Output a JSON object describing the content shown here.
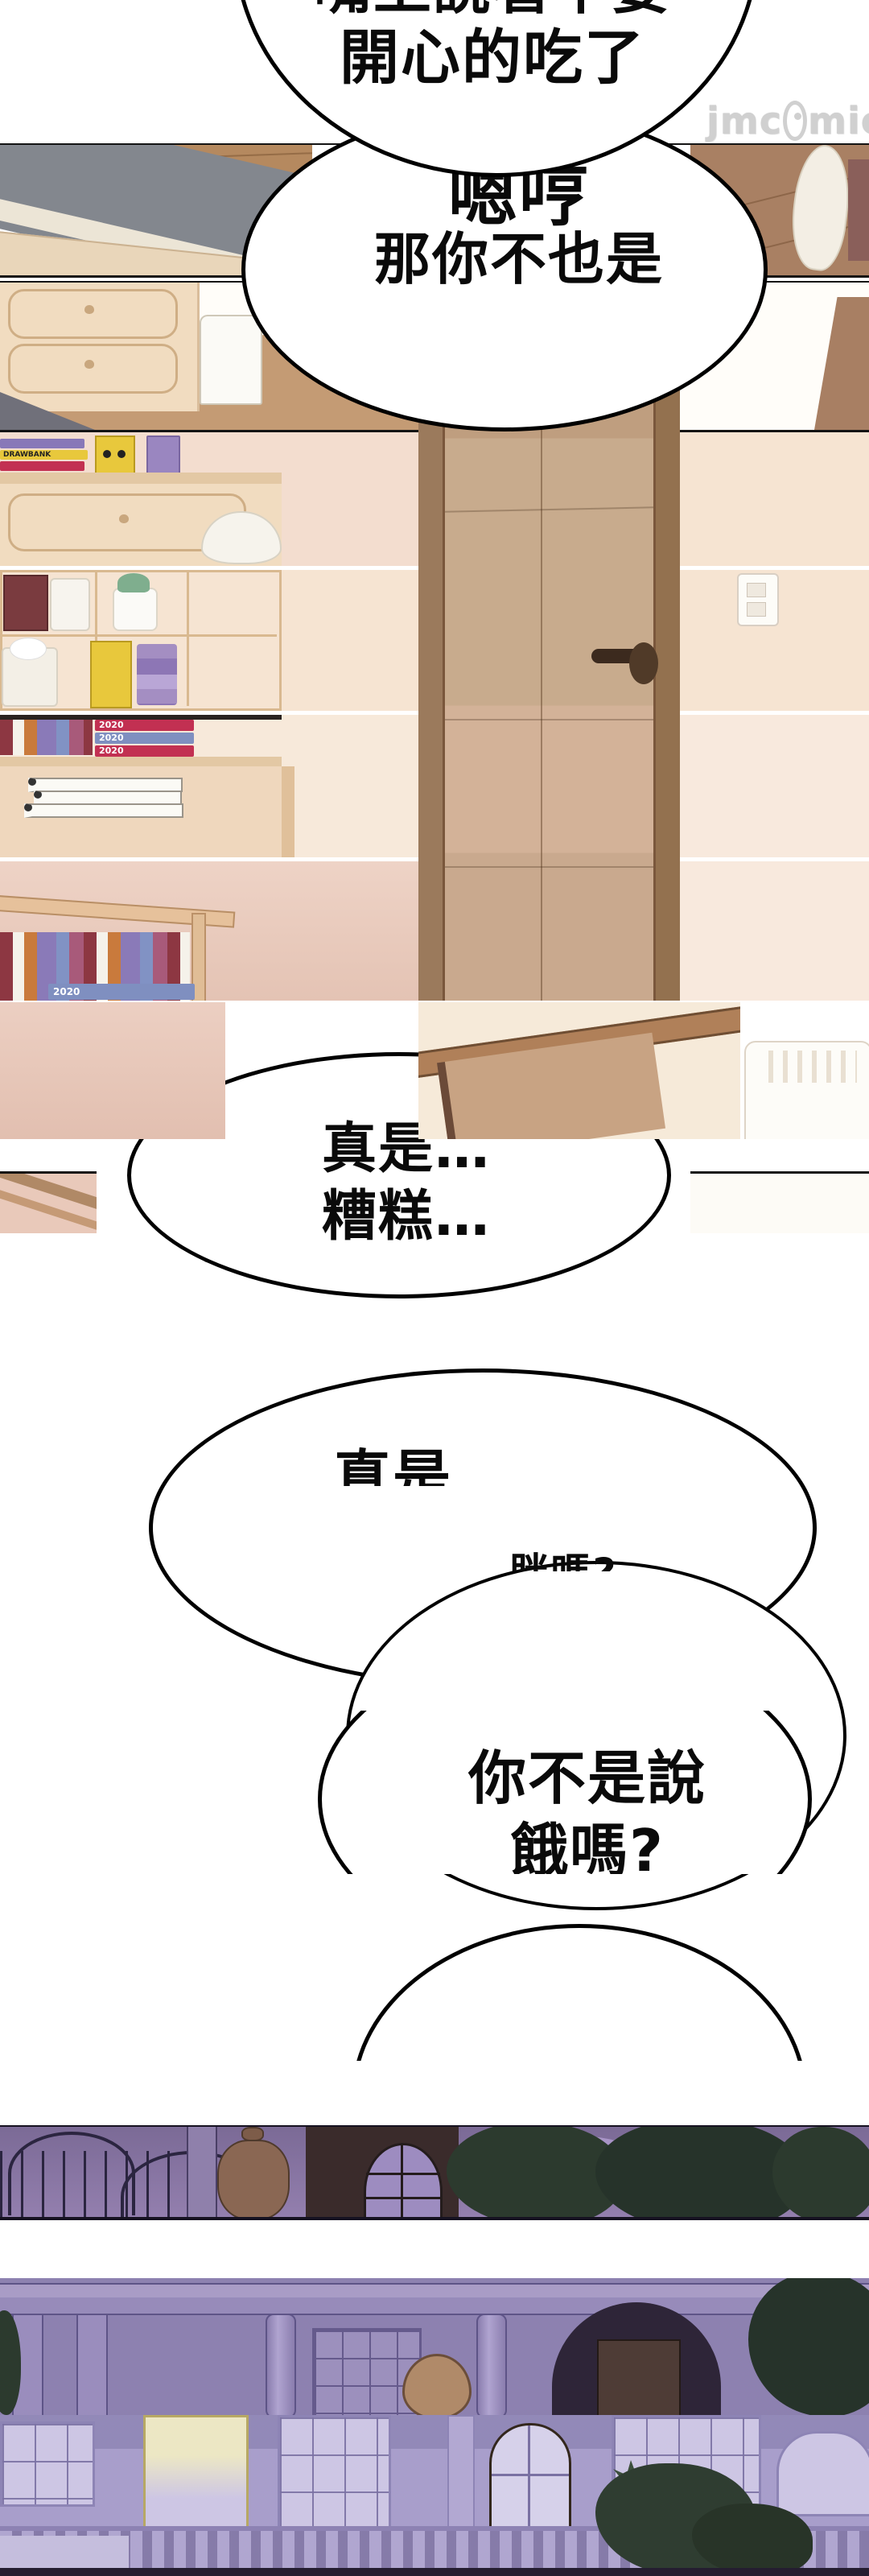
{
  "watermark": {
    "part1": "jmc",
    "part2": "mic",
    "mascot": "fish-mascot"
  },
  "bubble1": {
    "line1_clipped": "嘴上說著不要",
    "line2": "開心的吃了"
  },
  "bubble2": {
    "line1": "嗯哼",
    "line2": "那你不也是"
  },
  "bubble3": {
    "line1": "真是…",
    "line2": "糟糕…"
  },
  "bubble4": {
    "line1_clipped": "真是"
  },
  "bubble5": {
    "line1_clipped": "胖嗎?"
  },
  "bubble6": {
    "line1": "你不是說",
    "line2": "餓嗎?"
  },
  "books": {
    "drawbank": "DRAWBANK",
    "years": [
      "2020",
      "2020",
      "2020",
      "2020"
    ]
  },
  "colors": {
    "night_accent": "#8d81b0",
    "wood": "#c49b74",
    "bubble_stroke": "#000000"
  }
}
